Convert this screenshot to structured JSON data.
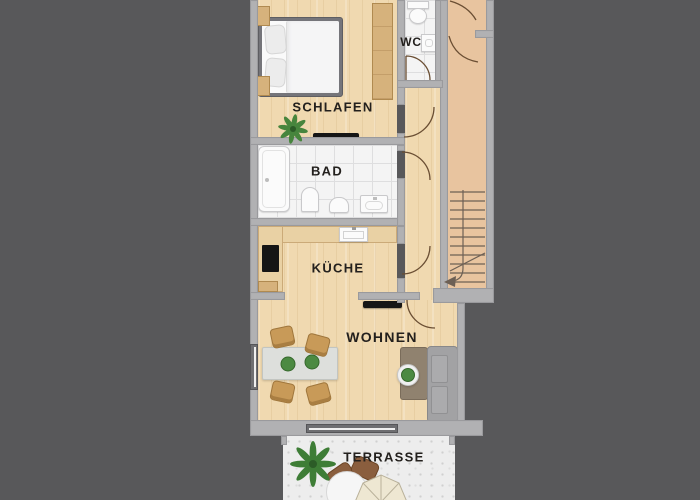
{
  "plan_title": "apartment-floor-plan",
  "labels": {
    "schlafen": "SCHLAFEN",
    "wc": "WC",
    "bad": "BAD",
    "kueche": "KÜCHE",
    "wohnen": "WOHNEN",
    "terrasse": "TERRASSE"
  },
  "colors": {
    "background": "#58585a",
    "wall": "#b1b1b3",
    "wood_floor": "#f0d9b0",
    "stairwell_floor": "#e8c49f",
    "tile_floor": "#f4f4f4",
    "terrace_floor": "#ededed",
    "door_arc": "#6a4e33",
    "stair_line": "#6d6055",
    "label_text": "#23201d",
    "plant_green": "#47853d",
    "sofa_gray": "#a2a2a4",
    "chair_wood": "#c89a58"
  }
}
